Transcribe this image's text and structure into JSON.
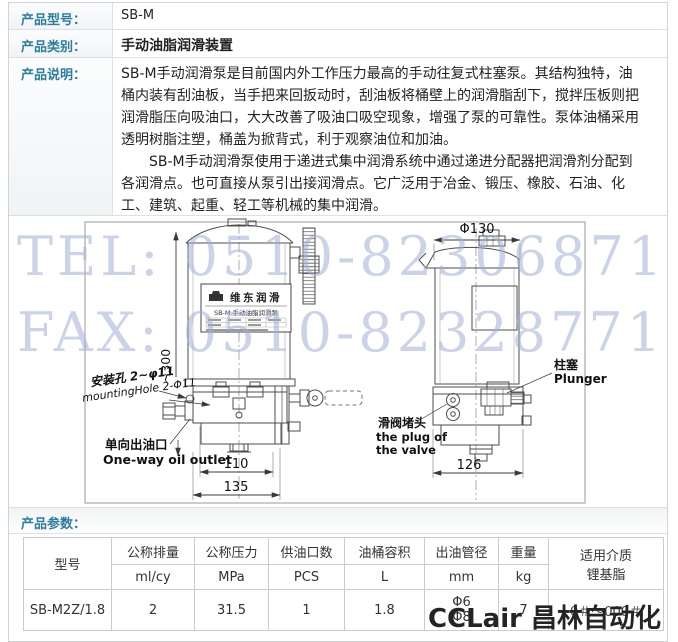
{
  "colors": {
    "accent": "#2e7d9e",
    "watermark": "#9fb0d4",
    "drawing_line": "#4d4d4d"
  },
  "info": {
    "model_label": "产品型号：",
    "model_value": "SB-M",
    "category_label": "产品类别：",
    "category_value": "手动油脂润滑装置",
    "desc_label": "产品说明：",
    "desc_p1": "SB-M手动润滑泵是目前国内外工作压力最高的手动往复式柱塞泵。其结构独特，油桶内装有刮油板，当手把来回扳动时，刮油板将桶壁上的润滑脂刮下，搅拌压板则把润滑脂压向吸油口，大大改善了吸油口吸空现象，增强了泵的可靠性。泵体油桶采用透明树脂注塑，桶盖为掀背式，利于观察油位和加油。",
    "desc_p2": "SB-M手动润滑泵使用于递进式集中润滑系统中通过递进分配器把润滑剂分配到各润滑点。也可直接从泵引出接润滑点。它广泛用于冶金、锻压、橡胶、石油、化工、建筑、起重、轻工等机械的集中润滑。"
  },
  "drawing": {
    "watermark_line1": "TEL: 0510-82306871",
    "watermark_line2": "FAX: 0510-82328771",
    "nameplate_brand": "维东润滑",
    "nameplate_model": "SB-M 手动油脂润滑泵",
    "dim_height": "~300",
    "dim_top_dia": "Φ130",
    "dim_base_110": "110",
    "dim_base_135": "135",
    "dim_base_126": "126",
    "label_mounting_cn": "安装孔 2~φ11",
    "label_mounting_en": "mountingHole 2-Φ11",
    "label_outlet_cn": "单向出油口",
    "label_outlet_en": "One-way oil outlet",
    "label_plug_cn": "滑阀堵头",
    "label_plug_en1": "the plug of",
    "label_plug_en2": "the valve",
    "label_plunger_cn": "柱塞",
    "label_plunger_en": "Plunger"
  },
  "params": {
    "section_label": "产品参数：",
    "headers": [
      {
        "name": "型号",
        "unit": ""
      },
      {
        "name": "公称排量",
        "unit": "ml/cy"
      },
      {
        "name": "公称压力",
        "unit": "MPa"
      },
      {
        "name": "供油口数",
        "unit": "PCS"
      },
      {
        "name": "油桶容积",
        "unit": "L"
      },
      {
        "name": "出油管径",
        "unit": "mm"
      },
      {
        "name": "重量",
        "unit": "kg"
      },
      {
        "name": "适用介质",
        "unit": "锂基脂"
      }
    ],
    "row": {
      "model": "SB-M2Z/1.8",
      "displacement": "2",
      "pressure": "31.5",
      "ports": "1",
      "capacity": "1.8",
      "pipe1": "Φ6",
      "pipe2": "Φ8",
      "weight": "7",
      "medium": "0＃～000＃"
    }
  },
  "footer_brand": "CCLair 昌林自动化"
}
